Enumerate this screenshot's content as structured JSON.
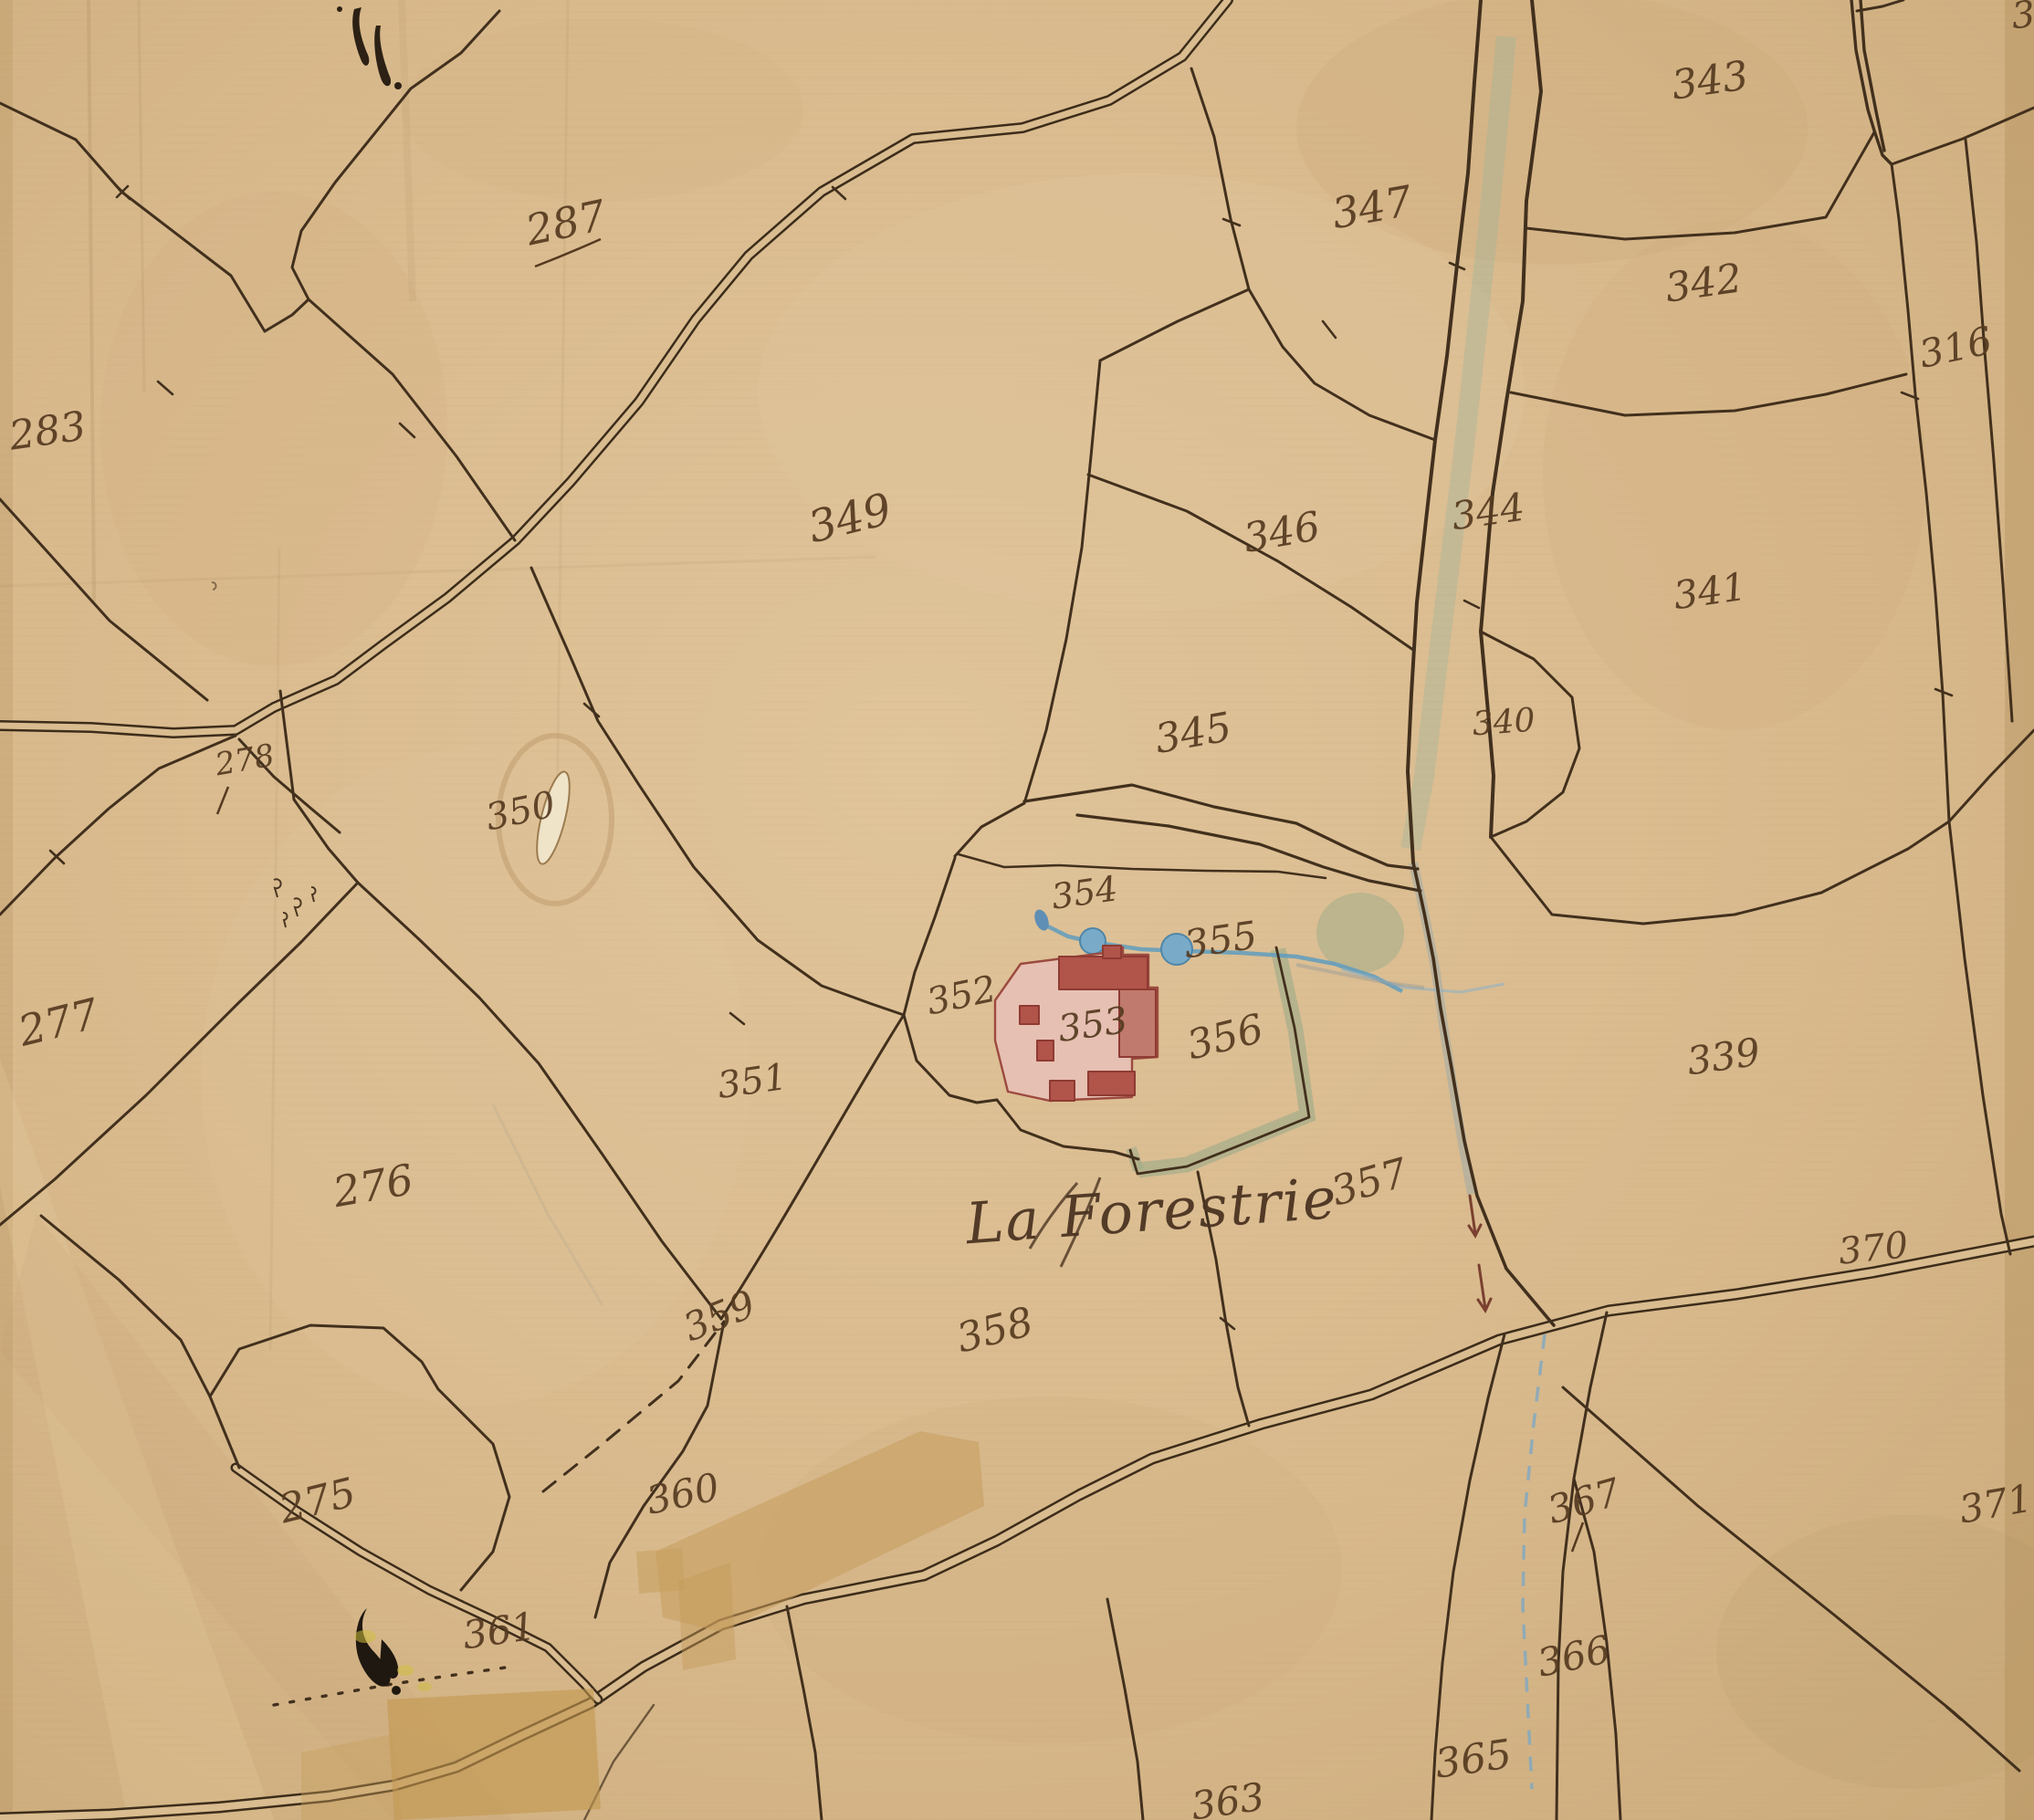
{
  "map": {
    "kind": "old cadastral plan (hand-drawn, watercolor on aged paper)",
    "place_label": "La Forestrie",
    "partial_edge_label": "3",
    "parcels": [
      {
        "label": "283"
      },
      {
        "label": "287"
      },
      {
        "label": "343"
      },
      {
        "label": "347"
      },
      {
        "label": "342"
      },
      {
        "label": "316"
      },
      {
        "label": "349"
      },
      {
        "label": "346"
      },
      {
        "label": "344"
      },
      {
        "label": "341"
      },
      {
        "label": "345"
      },
      {
        "label": "340"
      },
      {
        "label": "278"
      },
      {
        "label": "350"
      },
      {
        "label": "277"
      },
      {
        "label": "354"
      },
      {
        "label": "355"
      },
      {
        "label": "352"
      },
      {
        "label": "353"
      },
      {
        "label": "356"
      },
      {
        "label": "339"
      },
      {
        "label": "351"
      },
      {
        "label": "276"
      },
      {
        "label": "357"
      },
      {
        "label": "370"
      },
      {
        "label": "359"
      },
      {
        "label": "358"
      },
      {
        "label": "360"
      },
      {
        "label": "275"
      },
      {
        "label": "367"
      },
      {
        "label": "371"
      },
      {
        "label": "361"
      },
      {
        "label": "366"
      },
      {
        "label": "365"
      },
      {
        "label": "363"
      }
    ]
  },
  "colors": {
    "paper": "#d8b98c",
    "ink": "#42301d",
    "label_ink": "#553a20",
    "building_wash": "#e6c0b2",
    "building_roof": "#b1544a",
    "water_blue": "#6f9fbe",
    "garden_green": "#9cab89",
    "repair_tape": "#c69d5c"
  }
}
